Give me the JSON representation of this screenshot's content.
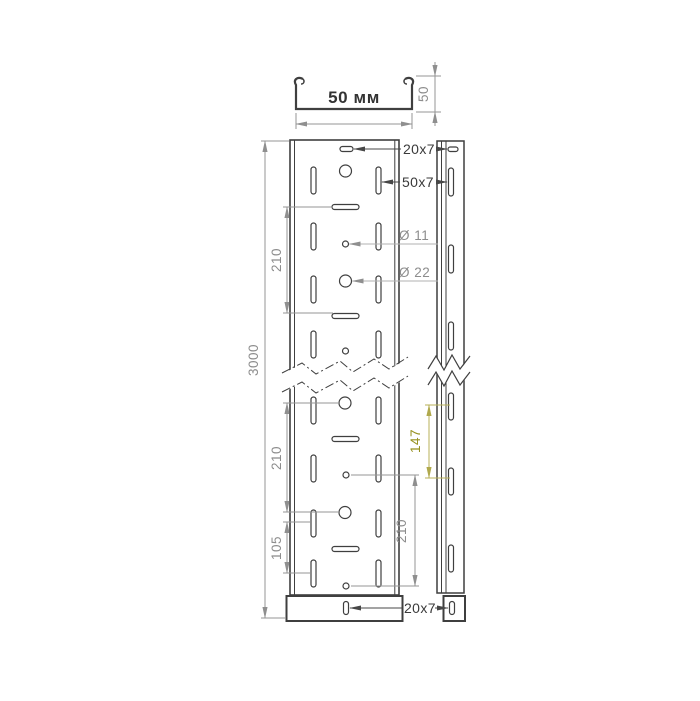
{
  "drawing": {
    "type": "technical-drawing",
    "subject": "perforated cable tray 50 mm",
    "end_view": {
      "width_label": "50 мм",
      "height_label": "50"
    },
    "front_view": {
      "top_slot_label": "20x7",
      "side_slot_label": "50x7",
      "small_hole_label": "Ø 11",
      "large_hole_label": "Ø 22",
      "total_length": "3000",
      "upper_pitch": "210",
      "lower_pitch": "210",
      "half_pitch": "105",
      "inner_pitch": "210",
      "bottom_slot_label": "20x7"
    },
    "side_view": {
      "slot_pitch": "147"
    },
    "colors": {
      "outline": "#3f3f3f",
      "dimension": "#8d8d8d",
      "accent_olive": "#97911f",
      "background": "#ffffff"
    }
  }
}
